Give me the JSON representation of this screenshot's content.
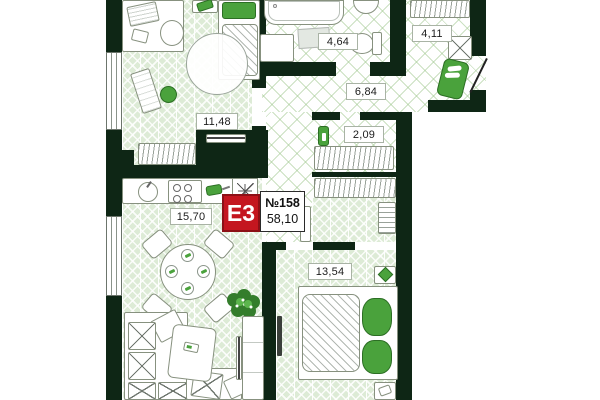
{
  "plan": {
    "badge": {
      "type_label": "E3",
      "number": "№158",
      "total_area": "58,10"
    },
    "rooms": [
      {
        "name": "room",
        "area": "11,48"
      },
      {
        "name": "bathroom",
        "area": "4,64"
      },
      {
        "name": "entry-hall",
        "area": "4,11"
      },
      {
        "name": "hallway",
        "area": "6,84"
      },
      {
        "name": "closet",
        "area": "2,09"
      },
      {
        "name": "kitchen-living-room",
        "area": "15,70"
      },
      {
        "name": "bedroom",
        "area": "13,54"
      }
    ],
    "colors": {
      "wall": "#0e2615",
      "floor_green": "#ddebd6",
      "accent_green": "#4aa23c",
      "badge_red": "#c4161f"
    }
  }
}
